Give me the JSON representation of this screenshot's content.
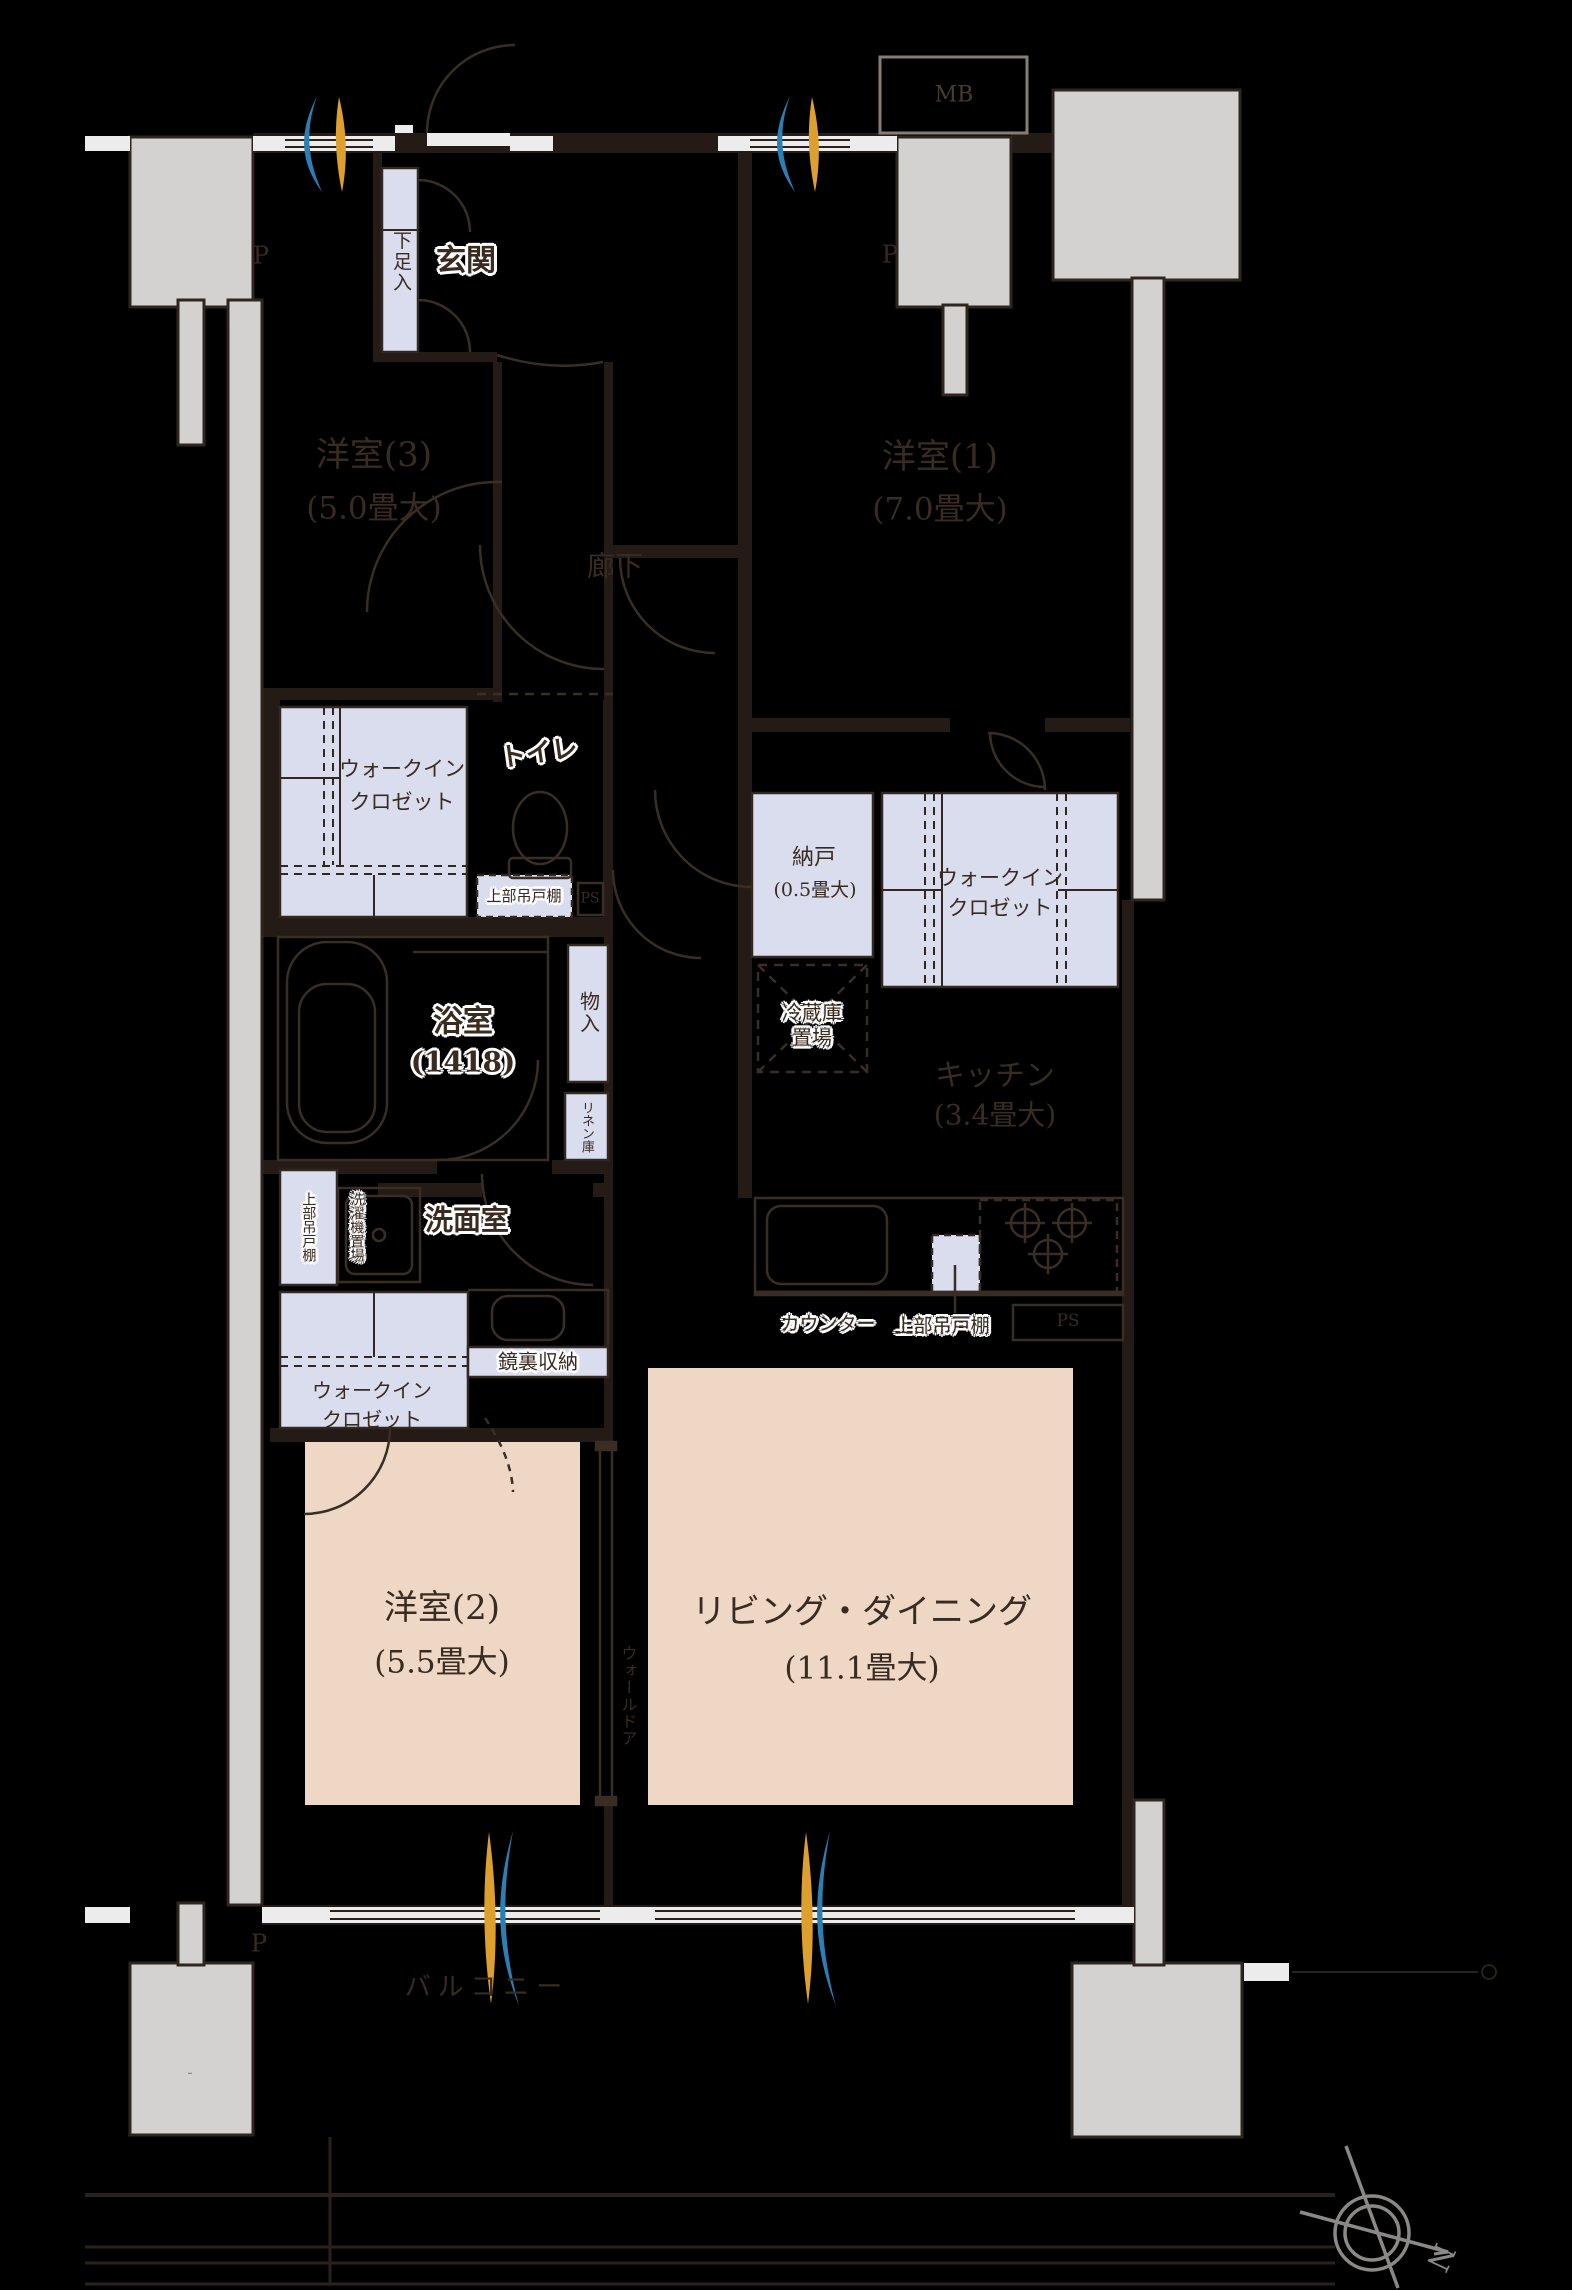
{
  "rooms": {
    "w3": {
      "name": "洋室(3)",
      "size": "(5.0畳大)"
    },
    "w1": {
      "name": "洋室(1)",
      "size": "(7.0畳大)"
    },
    "w2": {
      "name": "洋室(2)",
      "size": "(5.5畳大)"
    },
    "ld": {
      "name": "リビング・ダイニング",
      "size": "(11.1畳大)"
    },
    "kitchen": {
      "name": "キッチン",
      "size": "(3.4畳大)"
    },
    "nando": {
      "name": "納戸",
      "size": "(0.5畳大)"
    },
    "bath": {
      "name": "浴室",
      "size": "(1418)"
    },
    "genkan": "玄関",
    "rouka": "廊下",
    "senmen": "洗面室",
    "toilet": "トイレ",
    "balcony": "バルコニー"
  },
  "storage": {
    "wic_line1": "ウォークイン",
    "wic_line2": "クロゼット",
    "getabako": "下足入",
    "monoire": "物入",
    "linen": "リネン庫",
    "kagamiura": "鏡裏収納",
    "joubu": "上部吊戸棚",
    "sentakuki": "洗濯機置場",
    "walldoor": "ウォールドア",
    "counter": "カウンター",
    "reizo_line1": "冷蔵庫",
    "reizo_line2": "置場"
  },
  "marks": {
    "mb": "MB",
    "p": "P",
    "ps": "PS",
    "north": "N",
    "dash": "-"
  },
  "colors": {
    "background": "#000000",
    "wall": "#2b211c",
    "fixture_line": "#3a2d24",
    "closet_fill": "#d9ddee",
    "floor_pink": "#eed7c5",
    "pillar_gray": "#d3d2d1",
    "sill_white": "#ececec",
    "text": "#3a2b21",
    "swoosh_blue": "#2b7fb5",
    "swoosh_gold": "#dd9f2e",
    "compass_gray": "#8b8987"
  }
}
